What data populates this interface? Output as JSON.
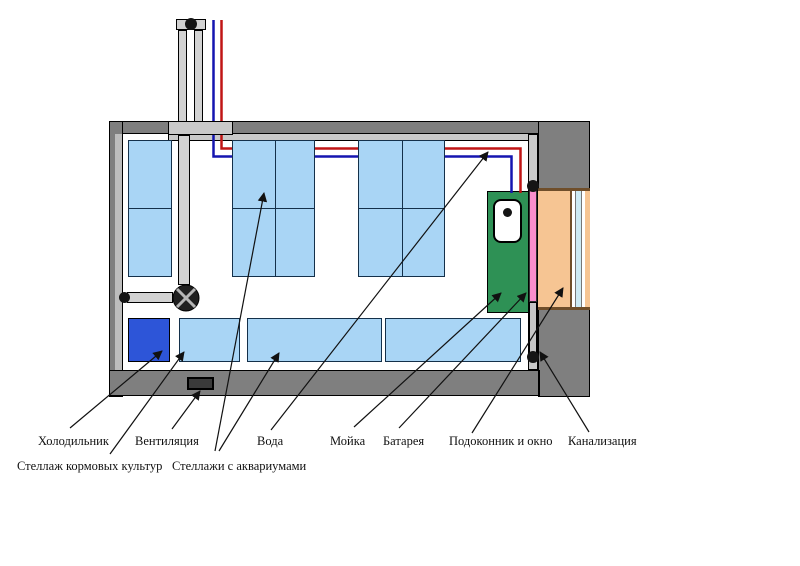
{
  "diagram": {
    "type": "floor-plan",
    "labels": {
      "fridge": "Холодильник",
      "ventilation": "Вентиляция",
      "water": "Вода",
      "sink": "Мойка",
      "radiator": "Батарея",
      "windowsill": "Подоконник и окно",
      "sewerage": "Канализация",
      "feed_rack": "Стеллаж кормовых культур",
      "aquarium_racks": "Стеллажи с аквариумами"
    },
    "colors": {
      "wall": "#7f7f7f",
      "wall_inner": "#c9c9c9",
      "rack_fill": "#a9d5f5",
      "fridge_fill": "#2d55d8",
      "sink_fill": "#2e9155",
      "radiator_fill": "#f98fcd",
      "windowsill_fill": "#f6c593",
      "window_glass_fill": "#cdeaf4",
      "hot_pipe": "#c01515",
      "cold_pipe": "#1515b0"
    }
  }
}
